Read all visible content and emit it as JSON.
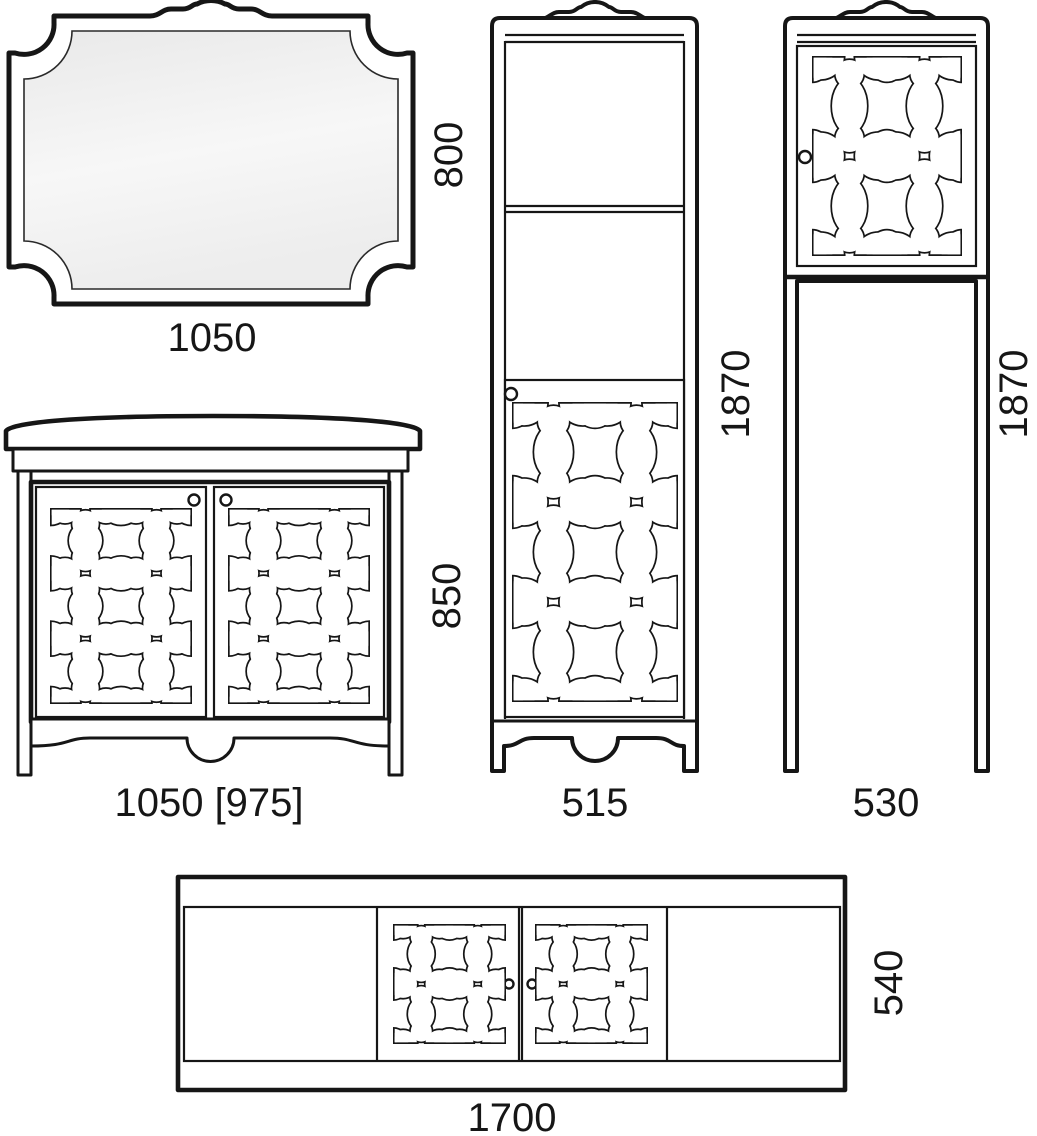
{
  "fixtures": {
    "mirror": {
      "width": "1050",
      "height": "800"
    },
    "vanity": {
      "width": "1050 [975]",
      "height": "850"
    },
    "tall_cabinet": {
      "width": "515",
      "height": "1870"
    },
    "open_cabinet": {
      "width": "530",
      "height": "1870"
    },
    "bath_panel": {
      "width": "1700",
      "height": "540"
    }
  },
  "colors": {
    "line": "#161616",
    "background": "#ffffff",
    "glass_light": "#f7f7f7",
    "glass_dark": "#e9e9e9"
  }
}
